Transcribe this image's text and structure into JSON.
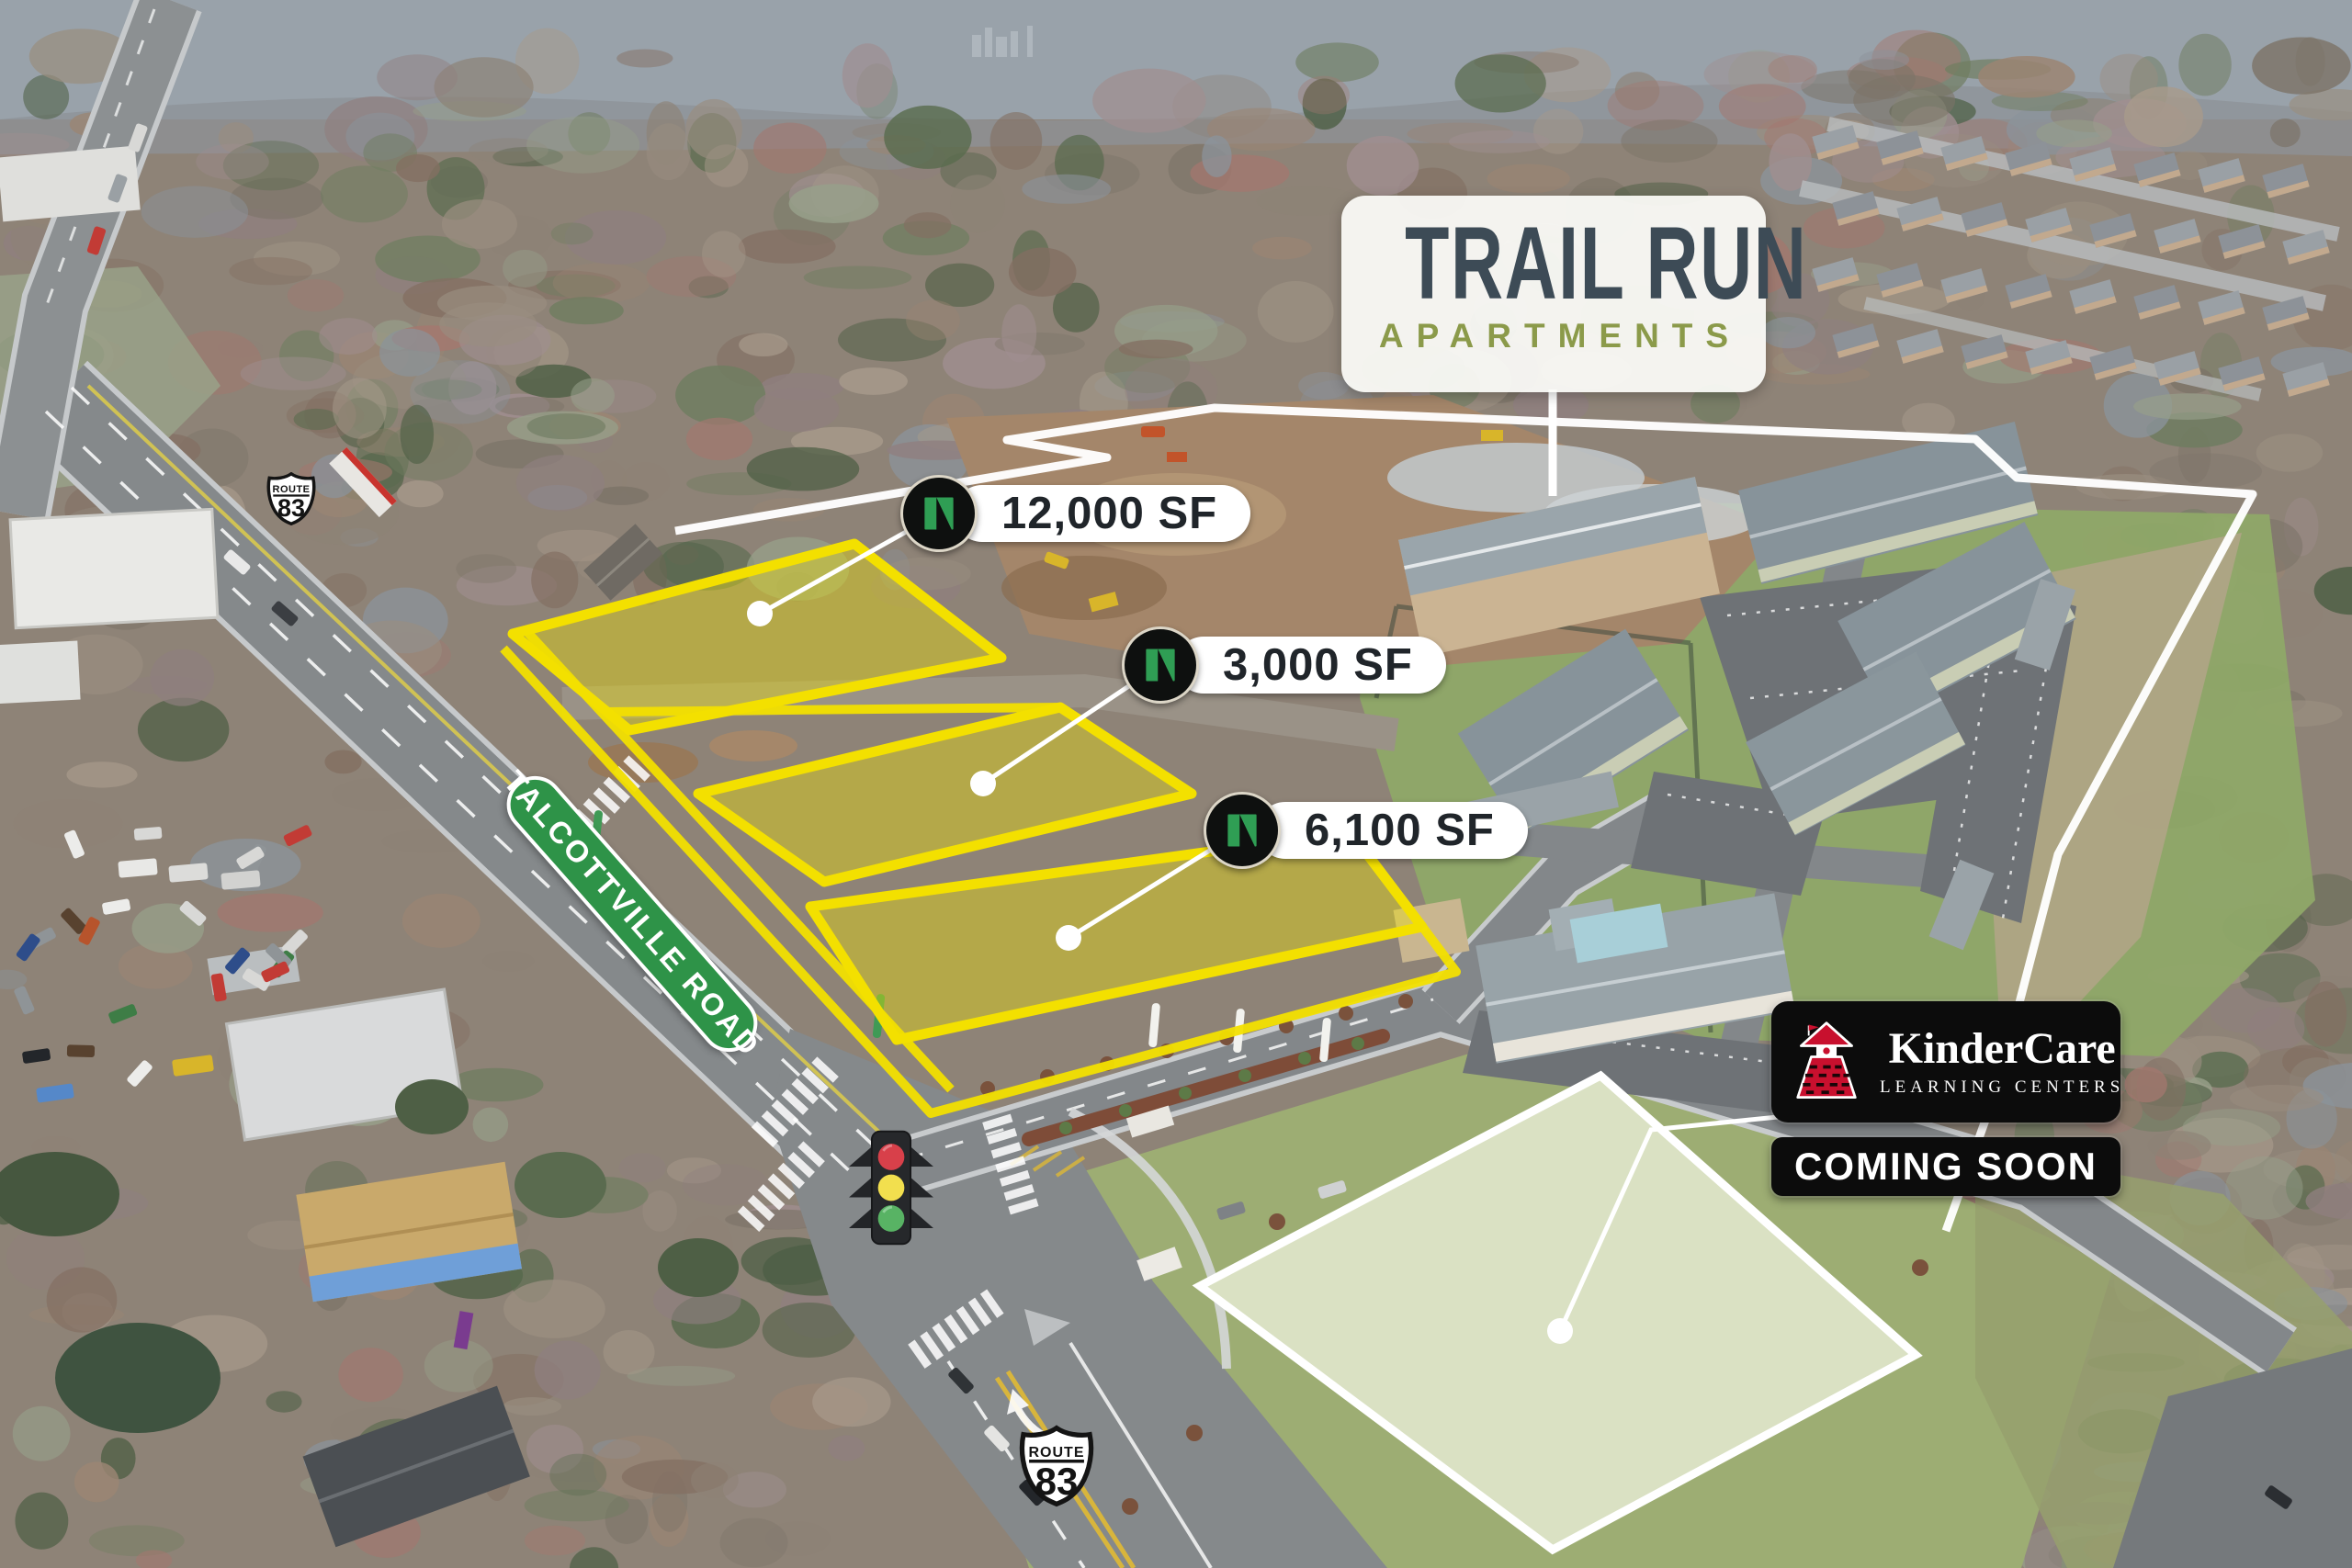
{
  "title_sign": {
    "title": "TRAIL RUN",
    "subtitle": "APARTMENTS"
  },
  "parcel_labels": [
    {
      "size": "12,000 SF"
    },
    {
      "size": "3,000 SF"
    },
    {
      "size": "6,100 SF"
    }
  ],
  "road_label": "TALCOTTVILLE ROAD",
  "route_shield": {
    "route_word": "ROUTE",
    "number": "83"
  },
  "kindercare": {
    "brand": "KinderCare",
    "tagline": "LEARNING CENTERS",
    "status": "COMING SOON"
  },
  "icons": {
    "parcel_marker": "n-logo-icon",
    "daycare": "schoolhouse-icon",
    "signal": "traffic-light-icon",
    "highway": "route-shield-icon"
  },
  "colors": {
    "overlay-yellow": "#f3e000",
    "overlay-white": "#ffffff",
    "sign-bg": "rgba(252,252,249,0.93)",
    "title-color": "#3d4b56",
    "subtitle-color": "#8b9a4a",
    "pill-bg": "#ffffff",
    "pill-text": "#20252a",
    "logo-green": "#2f9e54",
    "road-label-green": "#2e9348",
    "kindercare-bg": "#0c0c0c",
    "kindercare-red": "#c8102e",
    "shield-text": "#141414"
  }
}
